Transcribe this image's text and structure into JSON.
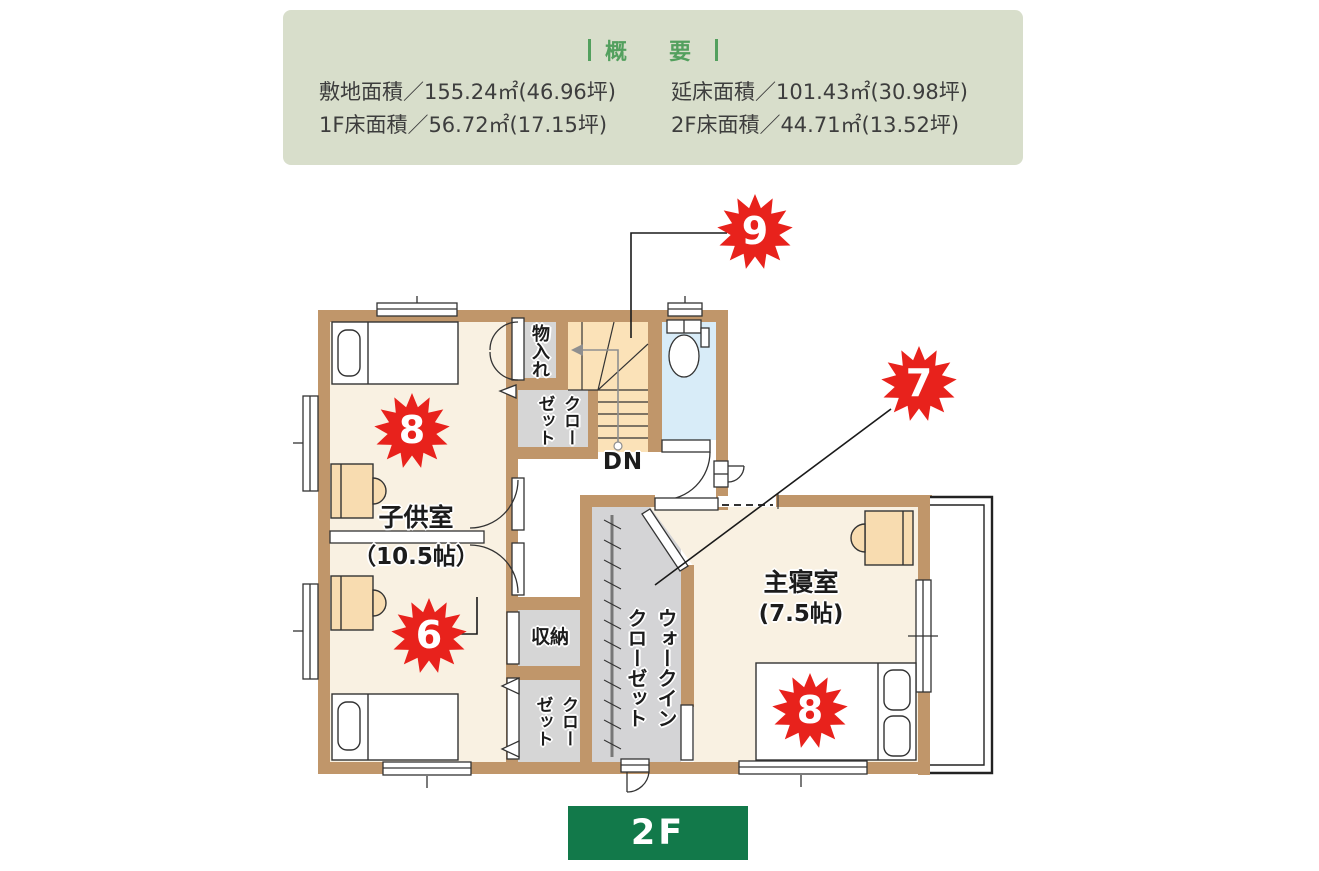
{
  "summary": {
    "title": "概　要",
    "rows": [
      {
        "left": "敷地面積／155.24㎡(46.96坪)",
        "right": "延床面積／101.43㎡(30.98坪)"
      },
      {
        "left": "1F床面積／56.72㎡(17.15坪)",
        "right": "2F床面積／44.71㎡(13.52坪)"
      }
    ]
  },
  "plan": {
    "labels": {
      "monoire": "物入れ",
      "closet_top": "クロー\nゼット",
      "dn": "DN",
      "kids_room_name": "子供室",
      "kids_room_size": "（10.5帖）",
      "shuno": "収納",
      "closet_bottom": "クロー\nゼット",
      "wic": "ウォークイン\nクローゼット",
      "master_name": "主寝室",
      "master_size": "(7.5帖)"
    },
    "badges": [
      {
        "id": "9",
        "value": "9"
      },
      {
        "id": "7",
        "value": "7"
      },
      {
        "id": "8-kids",
        "value": "8"
      },
      {
        "id": "6",
        "value": "6"
      },
      {
        "id": "8-master",
        "value": "8"
      }
    ]
  },
  "floor_label": "2F",
  "colors": {
    "wall": "#c0966a",
    "room_floor": "#f9f1e2",
    "stairs_floor": "#fbe2b8",
    "toilet_floor": "#d8ecf8",
    "closet_floor": "#d6d6d6",
    "desk": "#f8dcb0",
    "badge_red": "#e8221c",
    "summary_bg": "#d8decb",
    "summary_title_green": "#53a05e",
    "floor_label_bg": "#12794a"
  }
}
